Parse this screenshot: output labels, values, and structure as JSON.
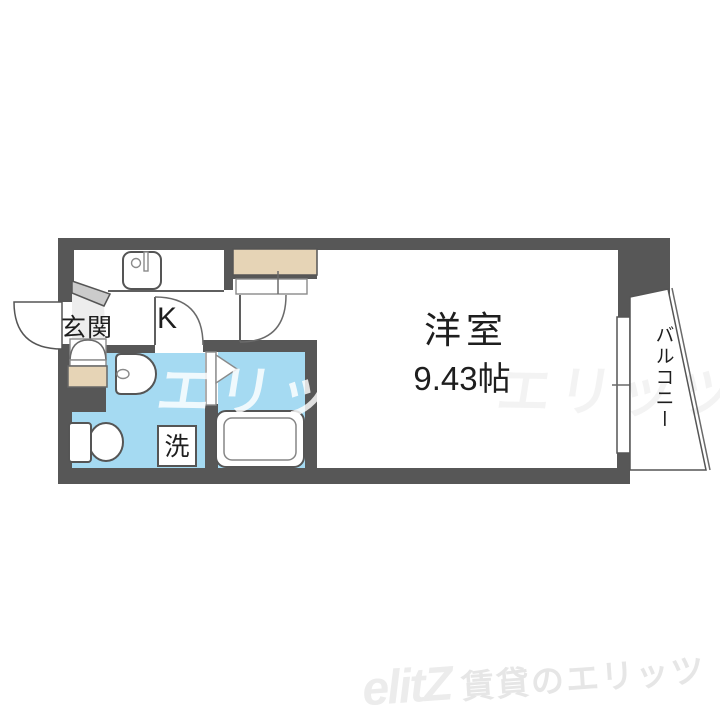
{
  "plan": {
    "labels": {
      "entrance": "玄関",
      "kitchen": "K",
      "laundry": "洗",
      "room_name": "洋室",
      "room_size": "9.43帖",
      "balcony": "バルコニー"
    },
    "colors": {
      "wall": "#575757",
      "water_area": "#a5daf2",
      "closet": "#e6d4b6",
      "entrance_step": "#cbcbcb"
    }
  },
  "watermark": {
    "text": "エリッツ",
    "text_faint": "エリッツ"
  },
  "logo": {
    "wordmark": "elitZ",
    "tagline": "賃貸のエリッツ"
  }
}
